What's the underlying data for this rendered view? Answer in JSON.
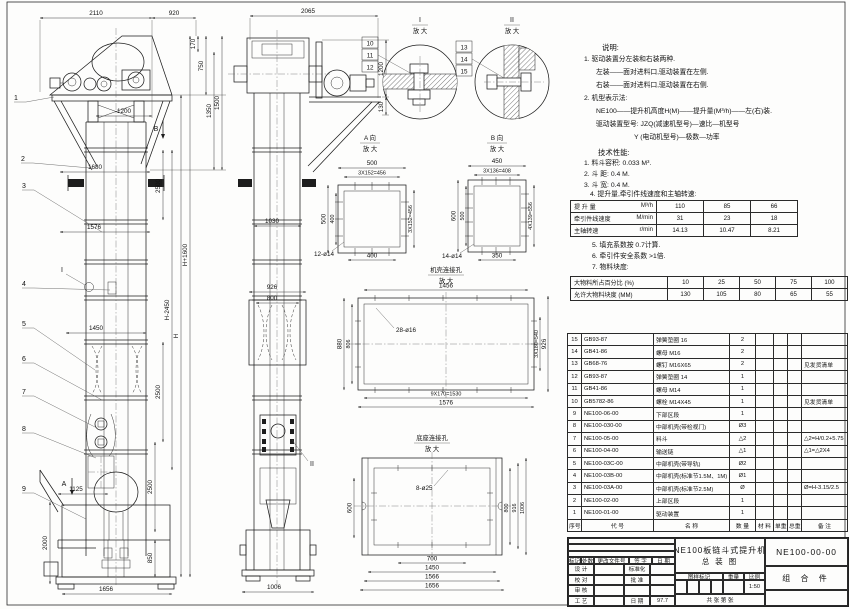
{
  "fv": {
    "d2110": "2110",
    "d920": "920",
    "d170": "170",
    "d750": "750",
    "d1350": "1350",
    "d1500": "1500",
    "d1200": "1200",
    "d1680": "1680",
    "d2500a": "2500",
    "d1576": "1576",
    "dHm": "H-2450",
    "dH": "H",
    "dHp": "H+1600",
    "d1450": "1450",
    "d2500b": "2500",
    "d2500c": "2500",
    "d1125": "1125",
    "d2000": "2000",
    "d850": "850",
    "d1656": "1656",
    "b1": "1",
    "b2": "2",
    "b3": "3",
    "b4": "4",
    "b5": "5",
    "b6": "6",
    "b7": "7",
    "b8": "8",
    "b9": "9",
    "sA": "A",
    "sB": "B",
    "dI": "I"
  },
  "sv": {
    "d2065": "2065",
    "d1200": "1200",
    "d130": "130",
    "d1030": "1030",
    "d926": "926",
    "d800": "800",
    "d1006": "1006",
    "dII": "II"
  },
  "det1": {
    "t": "I",
    "s": "放 大",
    "b10": "10",
    "b11": "11",
    "b12": "12"
  },
  "det2": {
    "t": "II",
    "s": "放 大",
    "b13": "13",
    "b14": "14",
    "b15": "15"
  },
  "va": {
    "t": "A 向",
    "s": "放 大",
    "top": "500",
    "topin": "3X152=456",
    "left": "500",
    "leftin": "400",
    "bot": "400",
    "right": "3X152=456",
    "holes": "12-ø14"
  },
  "vb": {
    "t": "B 向",
    "s": "放 大",
    "top": "450",
    "topin": "3X136=408",
    "left": "600",
    "leftin": "500",
    "right": "4X139=556",
    "bot": "350",
    "holes": "14-ø14"
  },
  "ch": {
    "t": "机壳连接孔",
    "s": "放 大",
    "top": "1456",
    "holes": "28-ø16",
    "left": "880",
    "leftin": "806",
    "rightin": "3X180=540",
    "right": "926",
    "bot1": "9X170=1530",
    "bot2": "1576"
  },
  "bh": {
    "t": "底座连接孔",
    "s": "放 大",
    "holes": "8-ø25",
    "left": "600",
    "r800": "800",
    "r916": "916",
    "r1006": "1006",
    "b700": "700",
    "b1450": "1450",
    "b1566": "1566",
    "b1656": "1656"
  },
  "notes": {
    "title": "说明:",
    "n1": "1. 驱动装置分左装和右装两种.",
    "n2": "左装——面对进料口,驱动装置在左侧.",
    "n3": "右装——面对进料口,驱动装置在右侧.",
    "n4": "2. 机型表示法:",
    "n5": "NE100——提升机高度H(M)——提升量(M³/h)——左(右)装.",
    "n6": "驱动装置型号: JZQ(减速机型号)—速比—机型号",
    "n7": "Y (电动机型号)—极数—功率",
    "tech": "技术性能:",
    "t1": "1. 料斗容积: 0.033 M³.",
    "t2": "2. 斗  距: 0.4 M.",
    "t3": "3. 斗  宽: 0.4 M.",
    "t4": "4. 提升量,牵引件线速度和主轴转速:",
    "a5": "5. 填充系数按 0.7计算.",
    "a6": "6. 牵引件安全系数 >1倍.",
    "a7": "7. 物料块度:"
  },
  "perf": {
    "rows": [
      {
        "label": "提 升 量",
        "unit": "M³/h",
        "v1": "110",
        "v2": "85",
        "v3": "66"
      },
      {
        "label": "牵引件线速度",
        "unit": "M/min",
        "v1": "31",
        "v2": "23",
        "v3": "18"
      },
      {
        "label": "主轴转速",
        "unit": "r/min",
        "v1": "14.13",
        "v2": "10.47",
        "v3": "8.21"
      }
    ]
  },
  "lump": {
    "r1label": "大物料所占百分比 (%)",
    "r1v1": "10",
    "r1v2": "25",
    "r1v3": "50",
    "r1v4": "75",
    "r1v5": "100",
    "r2label": "允许大物料块度 (MM)",
    "r2v1": "130",
    "r2v2": "105",
    "r2v3": "80",
    "r2v4": "65",
    "r2v5": "55"
  },
  "bom": {
    "h": {
      "no": "序号",
      "code": "代  号",
      "name": "名  称",
      "qty": "数 量",
      "mat": "材 料",
      "uw": "单重",
      "tw": "总重",
      "rem": "备 注"
    },
    "rows": [
      {
        "no": "15",
        "code": "GB93-87",
        "name": "弹簧垫圈  16",
        "qty": "2",
        "rem": ""
      },
      {
        "no": "14",
        "code": "GB41-86",
        "name": "螺母  M16",
        "qty": "2",
        "rem": ""
      },
      {
        "no": "13",
        "code": "GB68-76",
        "name": "螺钉  M16X65",
        "qty": "2",
        "rem": "见发货清单"
      },
      {
        "no": "12",
        "code": "GB93-87",
        "name": "弹簧垫圈  14",
        "qty": "1",
        "rem": ""
      },
      {
        "no": "11",
        "code": "GB41-86",
        "name": "螺母  M14",
        "qty": "1",
        "rem": ""
      },
      {
        "no": "10",
        "code": "GB5782-86",
        "name": "螺栓  M14X45",
        "qty": "1",
        "rem": "见发货清单"
      },
      {
        "no": "9",
        "code": "NE100-06-00",
        "name": "下部区段",
        "qty": "1",
        "rem": ""
      },
      {
        "no": "8",
        "code": "NE100-030-00",
        "name": "中部机壳(带检视门)",
        "qty": "Ø3",
        "rem": ""
      },
      {
        "no": "7",
        "code": "NE100-05-00",
        "name": "料斗",
        "qty": "△2",
        "rem": "△2=H/0.2+5.75"
      },
      {
        "no": "6",
        "code": "NE100-04-00",
        "name": "输送链",
        "qty": "△1",
        "rem": "△1=△2X4"
      },
      {
        "no": "5",
        "code": "NE100-03C-00",
        "name": "中部机壳(带导轨)",
        "qty": "Ø2",
        "rem": ""
      },
      {
        "no": "4",
        "code": "NE100-03B-00",
        "name": "中部机壳(标准节1.5M、1M)",
        "qty": "Ø1",
        "rem": ""
      },
      {
        "no": "3",
        "code": "NE100-03A-00",
        "name": "中部机壳(标准节2.5M)",
        "qty": "Ø",
        "rem": "Ø=H-3.15/2.5"
      },
      {
        "no": "2",
        "code": "NE100-02-00",
        "name": "上部区段",
        "qty": "1",
        "rem": ""
      },
      {
        "no": "1",
        "code": "NE100-01-00",
        "name": "驱动装置",
        "qty": "1",
        "rem": ""
      }
    ]
  },
  "tb": {
    "rh1": "标记",
    "rh2": "处数",
    "rh3": "更改文件号",
    "rh4": "签 字",
    "rh5": "日 期",
    "r1l": "设 计",
    "r1m": "标准化",
    "r2l": "校 对",
    "r2m": "批 准",
    "r3l": "审 核",
    "r3m": "",
    "r4l": "工 艺",
    "r4m": "日 期",
    "r4v": "97.7",
    "title1": "NE100板链斗式提升机",
    "title2": "总  装  图",
    "mark": "图样标记",
    "weight": "重量",
    "scale": "比例",
    "scalev": "1:50",
    "sheets": "共  张  第  张",
    "dwg": "NE100-00-00",
    "part": "组 合 件"
  }
}
